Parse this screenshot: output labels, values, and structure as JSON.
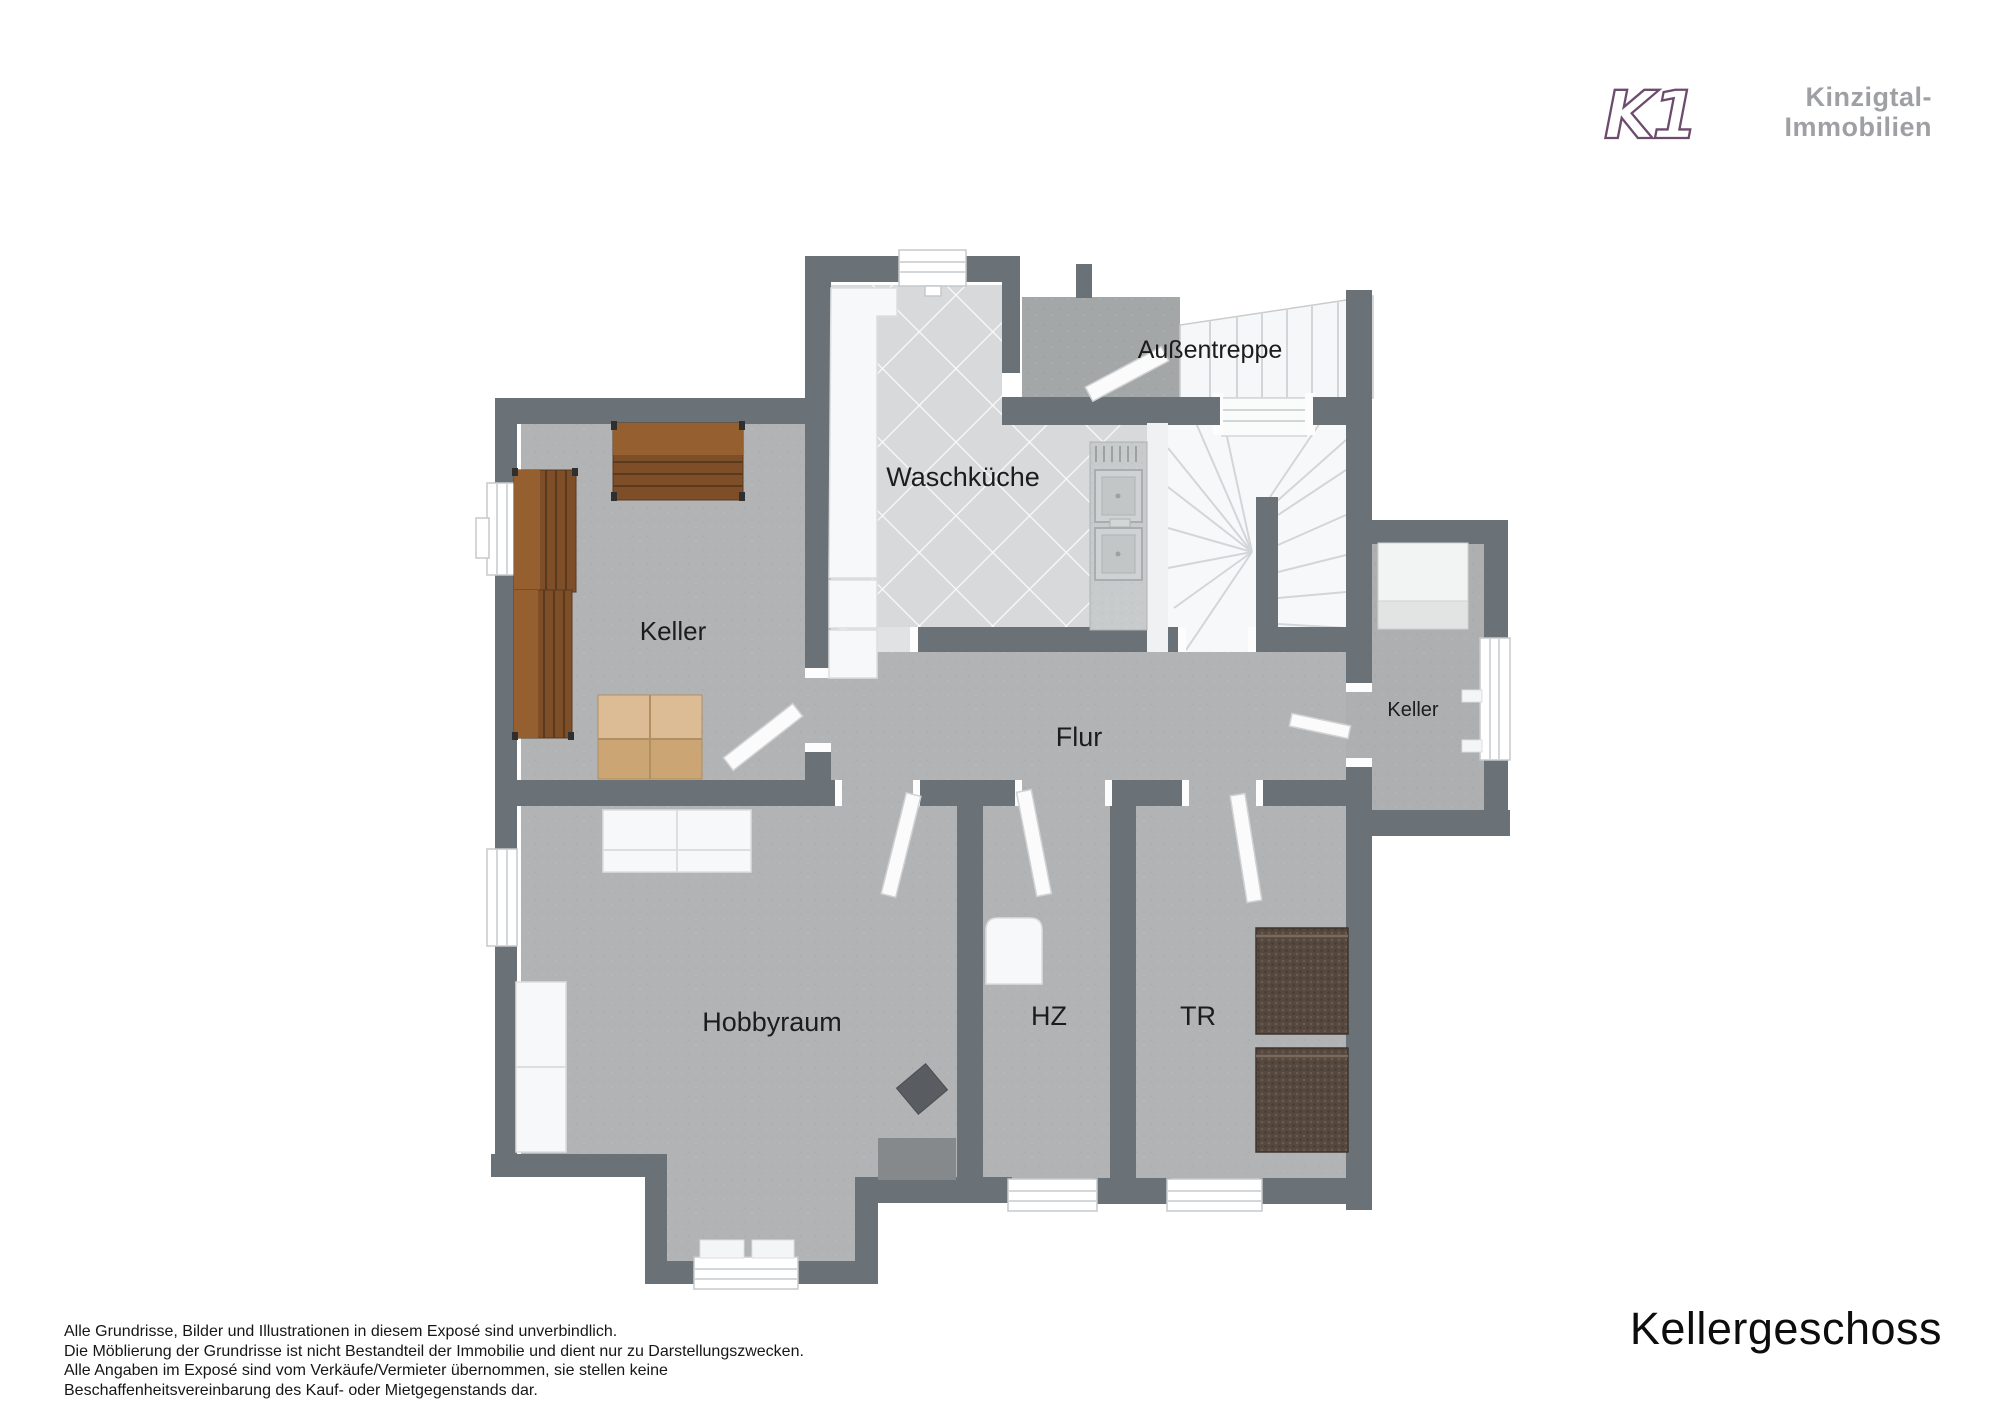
{
  "header": {
    "logo_text": "K1",
    "brand_line1": "Kinzigtal-",
    "brand_line2": "Immobilien"
  },
  "floorplan": {
    "rooms": [
      {
        "id": "waschkueche",
        "label": "Waschküche"
      },
      {
        "id": "aussentreppe",
        "label": "Außentreppe"
      },
      {
        "id": "keller",
        "label": "Keller"
      },
      {
        "id": "flur",
        "label": "Flur"
      },
      {
        "id": "keller-klein",
        "label": "Keller"
      },
      {
        "id": "hobbyraum",
        "label": "Hobbyraum"
      },
      {
        "id": "hz",
        "label": "HZ"
      },
      {
        "id": "tr",
        "label": "TR"
      }
    ]
  },
  "footer": {
    "title": "Kellergeschoss",
    "disclaimer_lines": [
      "Alle Grundrisse, Bilder und Illustrationen in diesem Exposé sind unverbindlich.",
      "Die Möblierung der Grundrisse ist nicht Bestandteil der Immobilie und dient nur zu Darstellungszwecken.",
      "Alle Angaben im Exposé sind vom Verkäufe/Vermieter übernommen, sie stellen keine",
      "Beschaffenheitsvereinbarung des Kauf- oder Mietgegenstands dar."
    ]
  },
  "colors": {
    "brand_purple": "#6d4b6d",
    "brand_gray": "#9ea0a3",
    "wall_gray": "#6a7177",
    "floor_gray": "#b2b3b5",
    "tile_gray": "#d7d9da",
    "label_black": "#1c1c1c"
  }
}
